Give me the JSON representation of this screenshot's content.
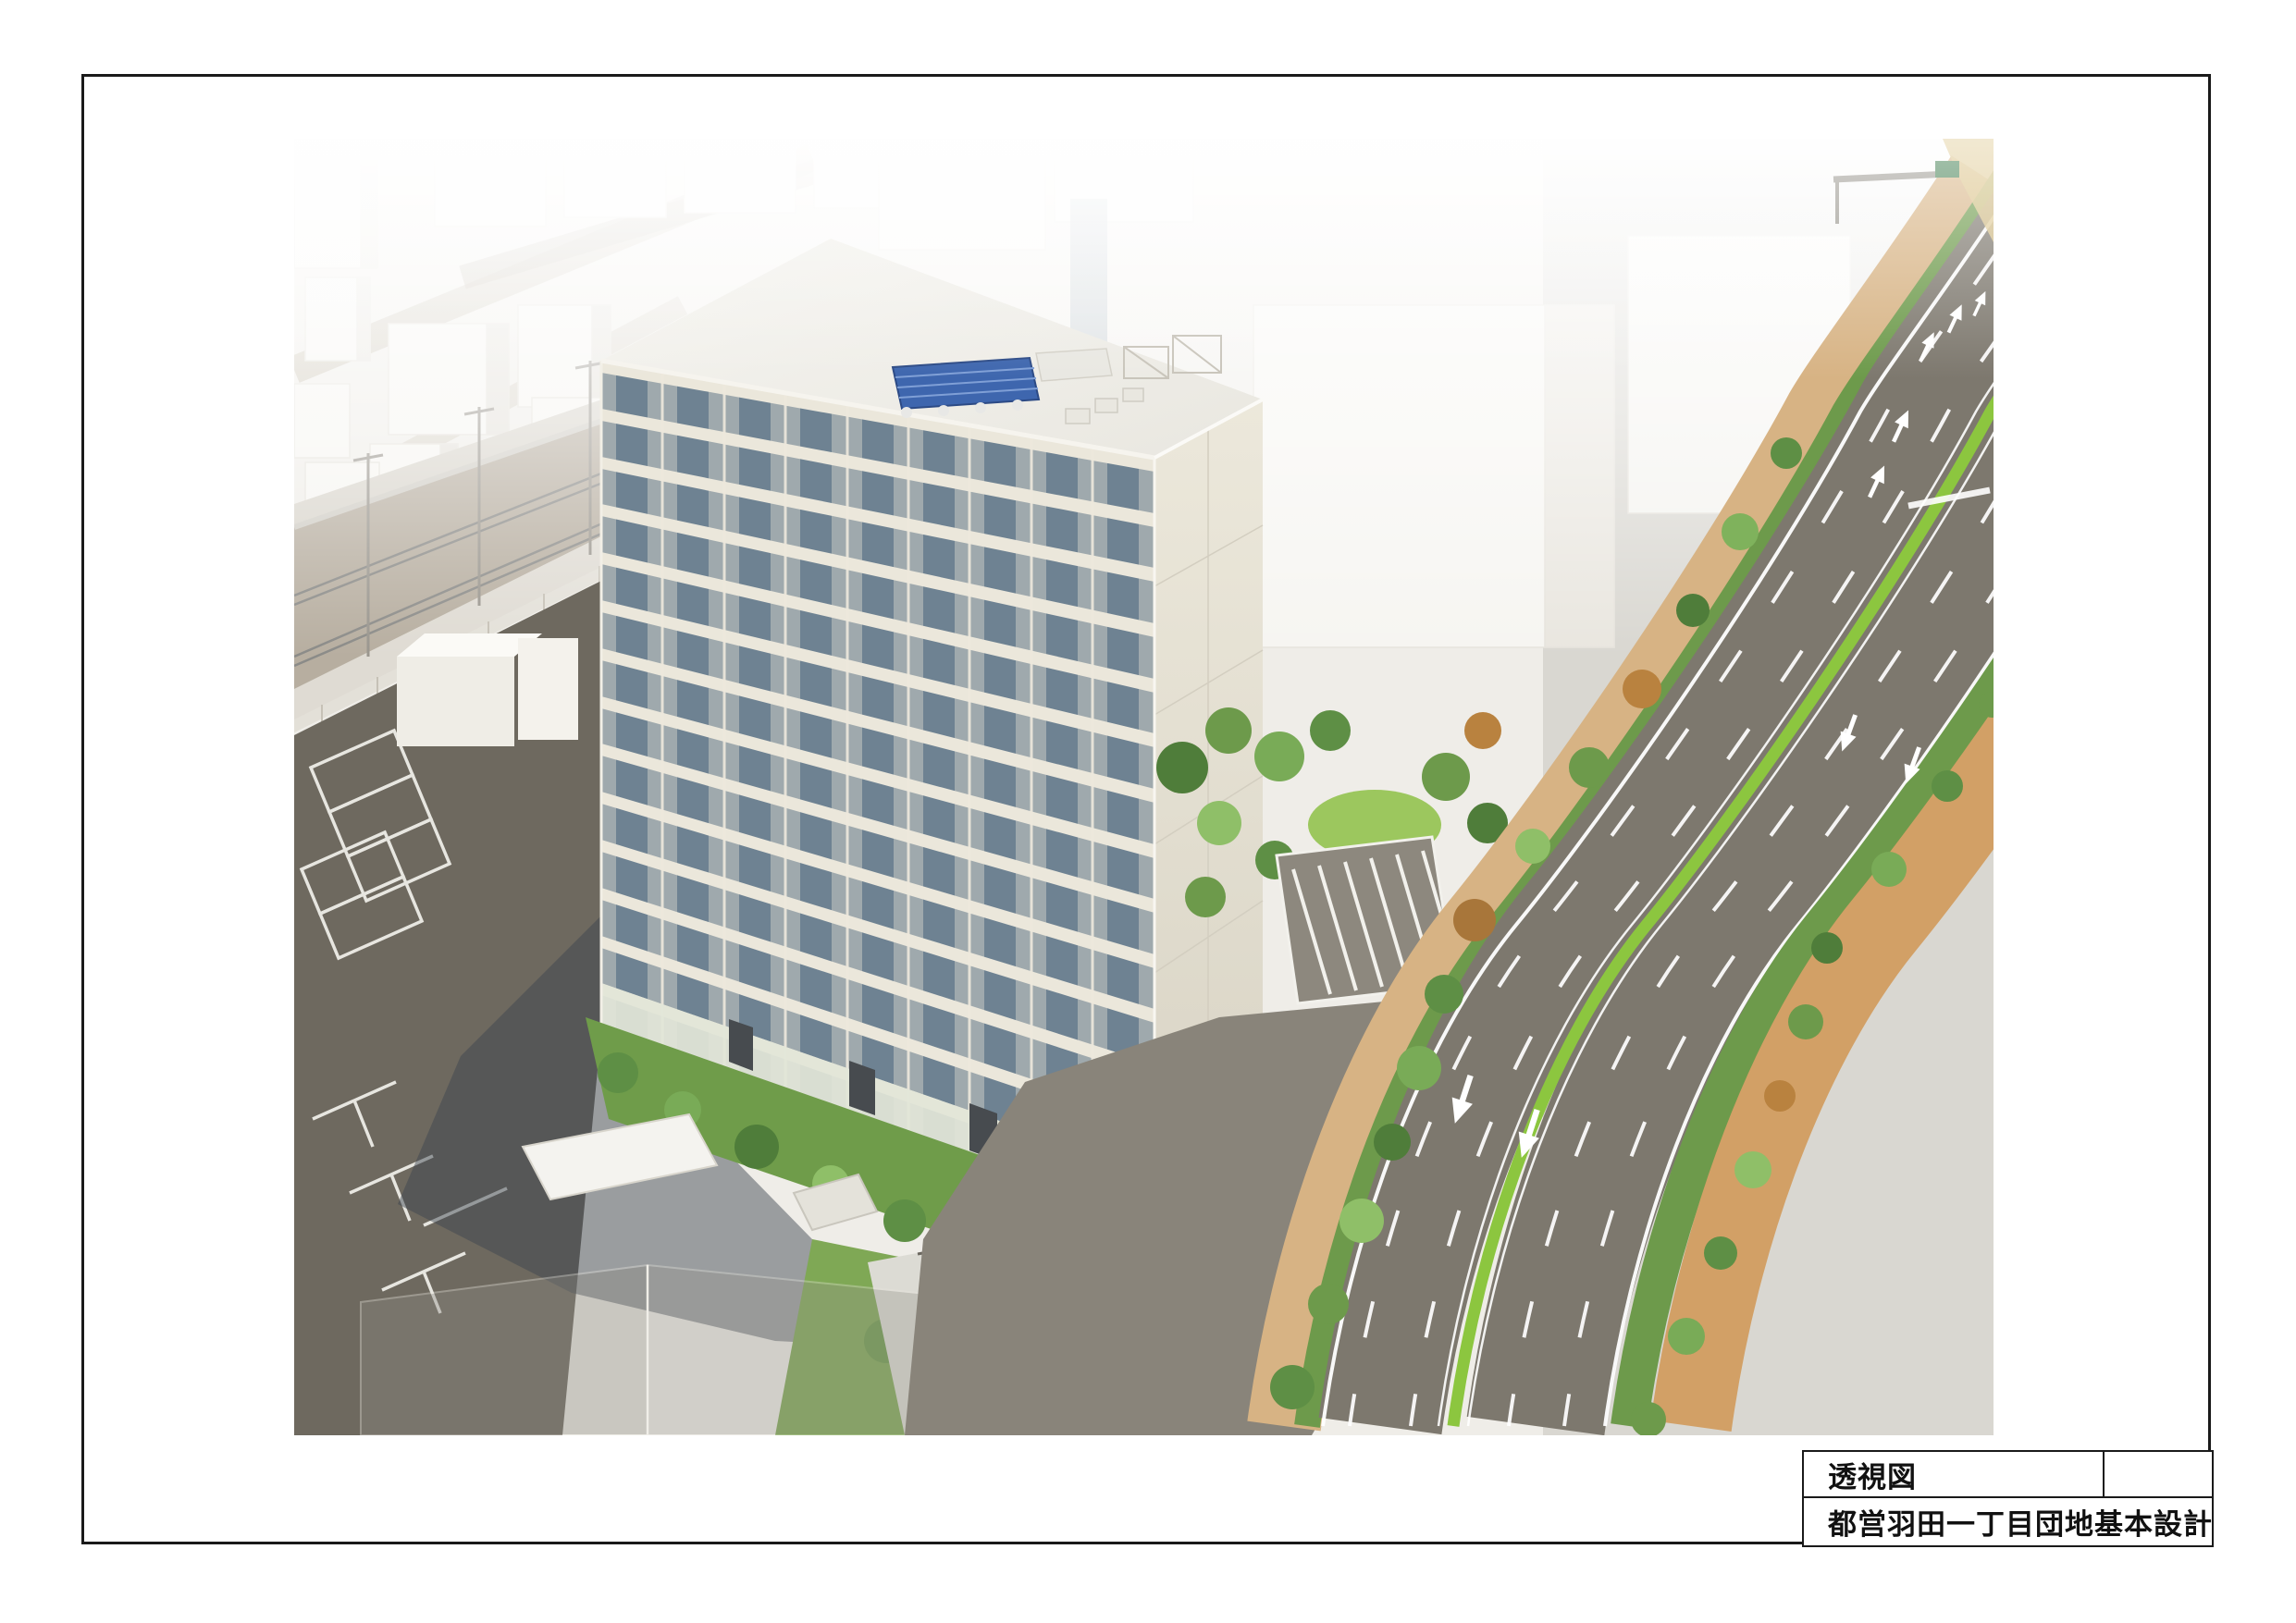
{
  "title_block": {
    "drawing_title": "透視図",
    "project_name": "都営羽田一丁目団地基本設計",
    "empty_cell": ""
  },
  "colors": {
    "frame-black": "#1a1a1a",
    "paper": "#ffffff",
    "facade-cream": "#ebe7db",
    "window-glass-dark": "#62798c",
    "side-wall-cream": "#e7e2d4",
    "roof-white": "#f3f2ed",
    "solar-panel-blue": "#3e66ae",
    "asphalt-dark": "#6e695f",
    "asphalt-road": "#7d786e",
    "median-green": "#8cc63f",
    "sidewalk-brick": "#d2a066",
    "tree-green": "#6d9a4b",
    "lawn-green": "#9cc75e",
    "ballast-grey": "#b7aea0",
    "massing-white": "#f6f5f1",
    "backdrop-grey": "#efede8",
    "shadow-slate": "#3d4450"
  }
}
